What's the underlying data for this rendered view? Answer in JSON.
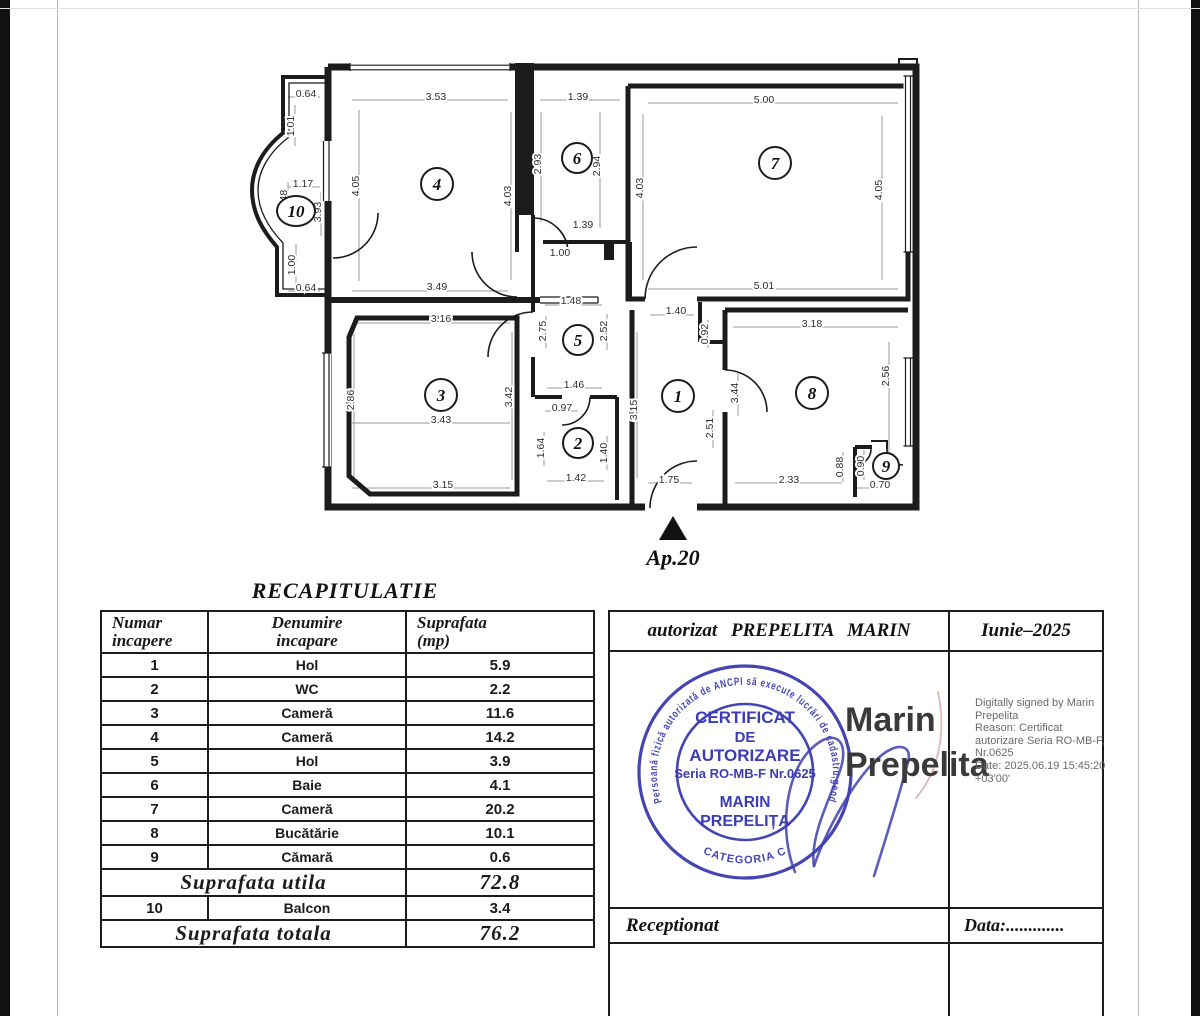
{
  "floor_plan": {
    "entrance_label": "Ap.20",
    "rooms": [
      {
        "n": "1",
        "x": 678,
        "y": 396,
        "rx": 16,
        "ry": 16
      },
      {
        "n": "2",
        "x": 578,
        "y": 443,
        "rx": 15,
        "ry": 15
      },
      {
        "n": "3",
        "x": 441,
        "y": 395,
        "rx": 16,
        "ry": 16
      },
      {
        "n": "4",
        "x": 437,
        "y": 184,
        "rx": 16,
        "ry": 16
      },
      {
        "n": "5",
        "x": 578,
        "y": 340,
        "rx": 15,
        "ry": 15
      },
      {
        "n": "6",
        "x": 577,
        "y": 158,
        "rx": 15,
        "ry": 15
      },
      {
        "n": "7",
        "x": 775,
        "y": 163,
        "rx": 16,
        "ry": 16
      },
      {
        "n": "8",
        "x": 812,
        "y": 393,
        "rx": 16,
        "ry": 16
      },
      {
        "n": "9",
        "x": 886,
        "y": 466,
        "rx": 13,
        "ry": 13
      },
      {
        "n": "10",
        "x": 296,
        "y": 211,
        "rx": 19,
        "ry": 15
      }
    ],
    "dimensions": [
      {
        "t": "0.64",
        "x": 306,
        "y": 97,
        "v": 0
      },
      {
        "t": "1.01",
        "x": 294,
        "y": 126,
        "v": 1
      },
      {
        "t": "1.17",
        "x": 303,
        "y": 187,
        "v": 0
      },
      {
        "t": "1.48",
        "x": 287,
        "y": 200,
        "v": 1
      },
      {
        "t": "3.93",
        "x": 321,
        "y": 212,
        "v": 1
      },
      {
        "t": "1.00",
        "x": 295,
        "y": 265,
        "v": 1
      },
      {
        "t": "0.64",
        "x": 306,
        "y": 291,
        "v": 0
      },
      {
        "t": "3.53",
        "x": 436,
        "y": 100,
        "v": 0
      },
      {
        "t": "4.05",
        "x": 359,
        "y": 186,
        "v": 1
      },
      {
        "t": "4.03",
        "x": 511,
        "y": 196,
        "v": 1
      },
      {
        "t": "3.49",
        "x": 437,
        "y": 290,
        "v": 0
      },
      {
        "t": "1.39",
        "x": 578,
        "y": 100,
        "v": 0
      },
      {
        "t": "2.93",
        "x": 541,
        "y": 164,
        "v": 1
      },
      {
        "t": "2.94",
        "x": 600,
        "y": 166,
        "v": 1
      },
      {
        "t": "1.39",
        "x": 583,
        "y": 228,
        "v": 0
      },
      {
        "t": "1.00",
        "x": 560,
        "y": 256,
        "v": 0
      },
      {
        "t": "5.00",
        "x": 764,
        "y": 103,
        "v": 0
      },
      {
        "t": "4.03",
        "x": 643,
        "y": 188,
        "v": 1
      },
      {
        "t": "4.05",
        "x": 882,
        "y": 190,
        "v": 1
      },
      {
        "t": "5.01",
        "x": 764,
        "y": 289,
        "v": 0
      },
      {
        "t": "1.48",
        "x": 571,
        "y": 304,
        "v": 0
      },
      {
        "t": "2.75",
        "x": 546,
        "y": 331,
        "v": 1
      },
      {
        "t": "2.52",
        "x": 607,
        "y": 331,
        "v": 1
      },
      {
        "t": "3.16",
        "x": 441,
        "y": 322,
        "v": 0
      },
      {
        "t": "2.86",
        "x": 354,
        "y": 400,
        "v": 1
      },
      {
        "t": "3.42",
        "x": 512,
        "y": 397,
        "v": 1
      },
      {
        "t": "3.43",
        "x": 441,
        "y": 423,
        "v": 0
      },
      {
        "t": "3.15",
        "x": 443,
        "y": 488,
        "v": 0
      },
      {
        "t": "1.46",
        "x": 574,
        "y": 388,
        "v": 0
      },
      {
        "t": "0.97",
        "x": 562,
        "y": 411,
        "v": 0
      },
      {
        "t": "1.64",
        "x": 544,
        "y": 448,
        "v": 1
      },
      {
        "t": "1.40",
        "x": 607,
        "y": 453,
        "v": 1
      },
      {
        "t": "1.42",
        "x": 576,
        "y": 481,
        "v": 0
      },
      {
        "t": "1.40",
        "x": 676,
        "y": 314,
        "v": 0
      },
      {
        "t": "0.92",
        "x": 708,
        "y": 334,
        "v": 1
      },
      {
        "t": "3.15",
        "x": 637,
        "y": 410,
        "v": 1
      },
      {
        "t": "2.51",
        "x": 713,
        "y": 428,
        "v": 1
      },
      {
        "t": "3.44",
        "x": 738,
        "y": 393,
        "v": 1
      },
      {
        "t": "1.75",
        "x": 669,
        "y": 483,
        "v": 0
      },
      {
        "t": "3.18",
        "x": 812,
        "y": 327,
        "v": 0
      },
      {
        "t": "2.56",
        "x": 889,
        "y": 376,
        "v": 1
      },
      {
        "t": "2.33",
        "x": 789,
        "y": 483,
        "v": 0
      },
      {
        "t": "0.88",
        "x": 843,
        "y": 467,
        "v": 1
      },
      {
        "t": "0.90",
        "x": 864,
        "y": 466,
        "v": 1
      },
      {
        "t": "0.70",
        "x": 880,
        "y": 488,
        "v": 0
      }
    ]
  },
  "recap": {
    "title": "RECAPITULATIE",
    "columns": [
      [
        "Numar",
        "incapere"
      ],
      [
        "Denumire",
        "incapare"
      ],
      [
        "Suprafata",
        "(mp)"
      ]
    ],
    "rows": [
      [
        "1",
        "Hol",
        "5.9"
      ],
      [
        "2",
        "WC",
        "2.2"
      ],
      [
        "3",
        "Cameră",
        "11.6"
      ],
      [
        "4",
        "Cameră",
        "14.2"
      ],
      [
        "5",
        "Hol",
        "3.9"
      ],
      [
        "6",
        "Baie",
        "4.1"
      ],
      [
        "7",
        "Cameră",
        "20.2"
      ],
      [
        "8",
        "Bucătărie",
        "10.1"
      ],
      [
        "9",
        "Cămară",
        "0.6"
      ]
    ],
    "summary_utila": {
      "label": "Suprafata  utila",
      "value": "72.8"
    },
    "balcon_row": [
      "10",
      "Balcon",
      "3.4"
    ],
    "summary_totala": {
      "label": "Suprafata  totala",
      "value": "76.2"
    }
  },
  "authorization": {
    "header_left": "autorizat PREPELITA MARIN",
    "header_right": "Iunie–2025",
    "stamp": {
      "color": "#4444b2",
      "lines": [
        "CERTIFICAT",
        "DE",
        "AUTORIZARE",
        "Seria RO-MB-F Nr.0625",
        "MARIN",
        "PREPELIȚA"
      ],
      "rim_top": "Persoană fizică autorizată de ANCPI să execute lucrări de cadastru,geodezie și",
      "rim_bottom": "CATEGORIA C"
    },
    "signature_name": [
      "Marin",
      "Prepelita"
    ],
    "digital_signature": [
      "Digitally signed by Marin",
      "Prepelita",
      "Reason: Certificat",
      "autorizare Seria RO-MB-F,",
      "Nr.0625",
      "Date: 2025.06.19 15:45:20",
      "+03'00'"
    ],
    "receptionat": "Receptionat",
    "data_label": "Data:............."
  }
}
